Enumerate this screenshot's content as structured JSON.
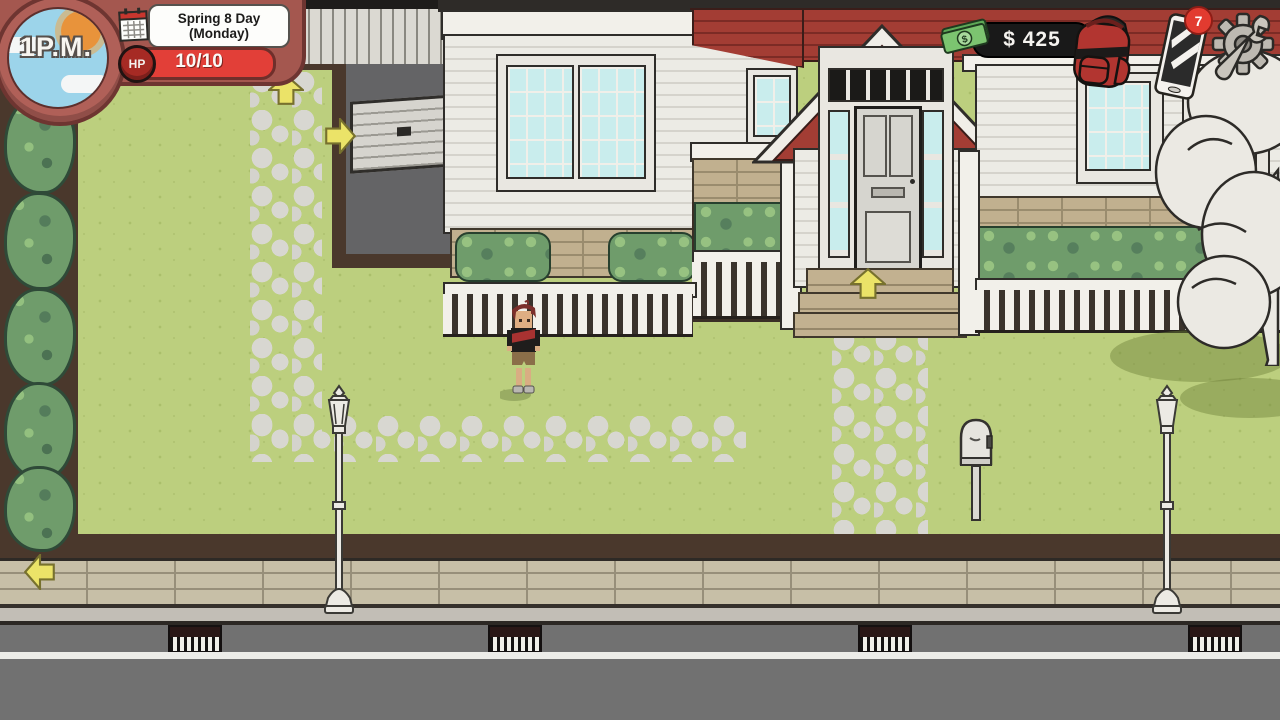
{
  "hud": {
    "clock": {
      "time": "1P.M.",
      "icon": "sun-clock"
    },
    "date": {
      "season_day": "Spring 8 Day",
      "weekday": "(Monday)",
      "icon": "calendar-icon"
    },
    "hp": {
      "label": "HP",
      "value": "10/10"
    },
    "money": {
      "amount": "$ 425",
      "icon": "cash-icon"
    },
    "backpack": {
      "icon": "backpack-icon"
    },
    "phone": {
      "icon": "phone-icon",
      "notification_count": "7"
    },
    "settings": {
      "icon": "gear-icon"
    }
  },
  "scene": {
    "location": "suburban house front yard",
    "markers": {
      "path_exit": "up-arrow",
      "cellar_door": "right-arrow",
      "front_door": "up-arrow",
      "sidewalk_exit": "left-arrow"
    },
    "colors": {
      "lawn": "#bccf7e",
      "dirt": "#4a382c",
      "stone_path": "#d8d7d1",
      "sidewalk": "#c7bfa7",
      "street": "#717171",
      "roof_red": "#a33d34",
      "siding": "#ecebe5",
      "window_glass": "#c9eded",
      "hedge": "#6f9c6b",
      "arrow_yellow": "#ebe368",
      "hud_panel": "#a4574f",
      "hp_red": "#e23f38",
      "money_pill": "#191919",
      "notification_red": "#e23b30",
      "backpack_red": "#b23530"
    }
  }
}
